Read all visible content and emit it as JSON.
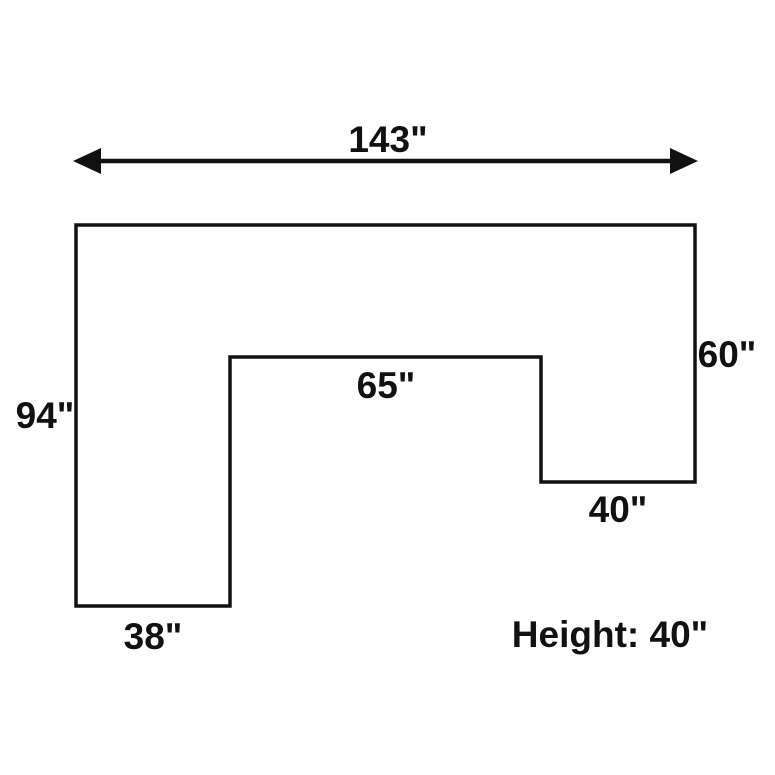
{
  "diagram": {
    "labels": {
      "total_width": "143\"",
      "left_height": "94\"",
      "notch_width": "65\"",
      "right_height": "60\"",
      "right_bottom_width": "40\"",
      "left_bottom_width": "38\"",
      "height_note": "Height: 40\""
    },
    "values_inches": {
      "total_width": 143,
      "left_height": 94,
      "notch_width": 65,
      "right_height": 60,
      "right_bottom_width": 40,
      "left_bottom_width": 38,
      "height": 40
    },
    "colors": {
      "line": "#111111",
      "text": "#111111",
      "background": "#ffffff"
    }
  }
}
